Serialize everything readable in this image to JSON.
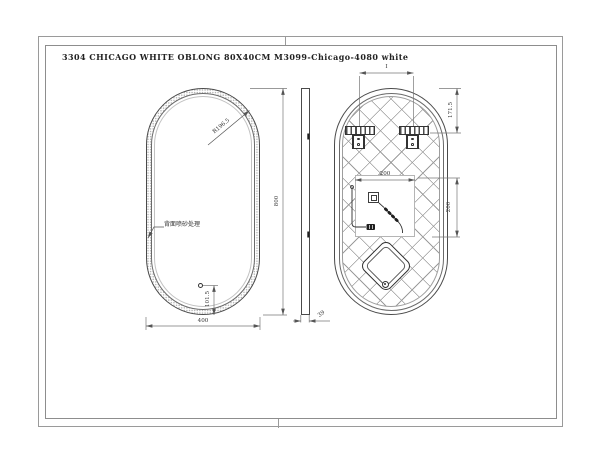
{
  "drawing": {
    "title": "3304 CHICAGO WHITE OBLONG 80X40CM M3099-Chicago-4080 white",
    "front_view": {
      "corner_radius_label": "R196.5",
      "back_note": "背面喷砂处理",
      "sensor_to_bottom": "101.5",
      "overall_width": "400",
      "overall_height": "800"
    },
    "side_view": {
      "thickness": "39"
    },
    "back_view": {
      "hanger_spacing_label": "I",
      "top_to_hanger": "171.5",
      "cutout_width": "200",
      "cutout_height": "200"
    }
  }
}
